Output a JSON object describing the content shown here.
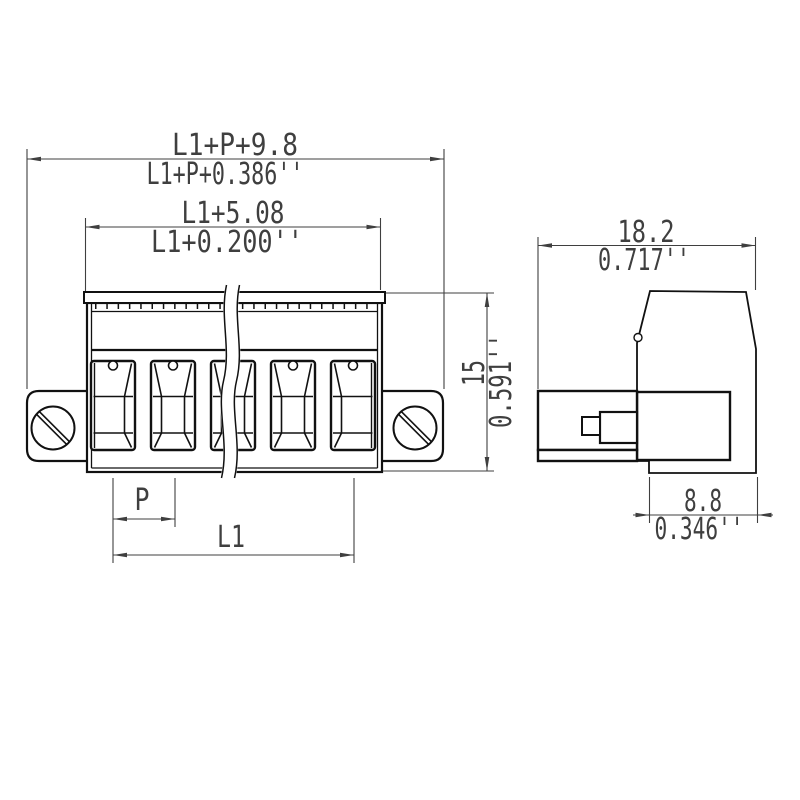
{
  "drawing": {
    "background": "#ffffff",
    "outline_color": "#111111",
    "dimension_color": "#3f3f3f",
    "front_view": {
      "visible_terminals": 5,
      "mounting_screws": 2,
      "has_break_lines": true
    },
    "side_view": {
      "profile": "connector side profile with plug shroud"
    }
  },
  "dims": {
    "overall": {
      "mm": "L1+P+9.8",
      "inch": "L1+P+0.386''"
    },
    "inner": {
      "mm": "L1+5.08",
      "inch": "L1+0.200''"
    },
    "height": {
      "mm": "15",
      "inch": "0.591''"
    },
    "depth": {
      "mm": "18.2",
      "inch": "0.717''"
    },
    "base": {
      "mm": "8.8",
      "inch": "0.346''"
    },
    "pitch": {
      "label": "P"
    },
    "length": {
      "label": "L1"
    }
  }
}
